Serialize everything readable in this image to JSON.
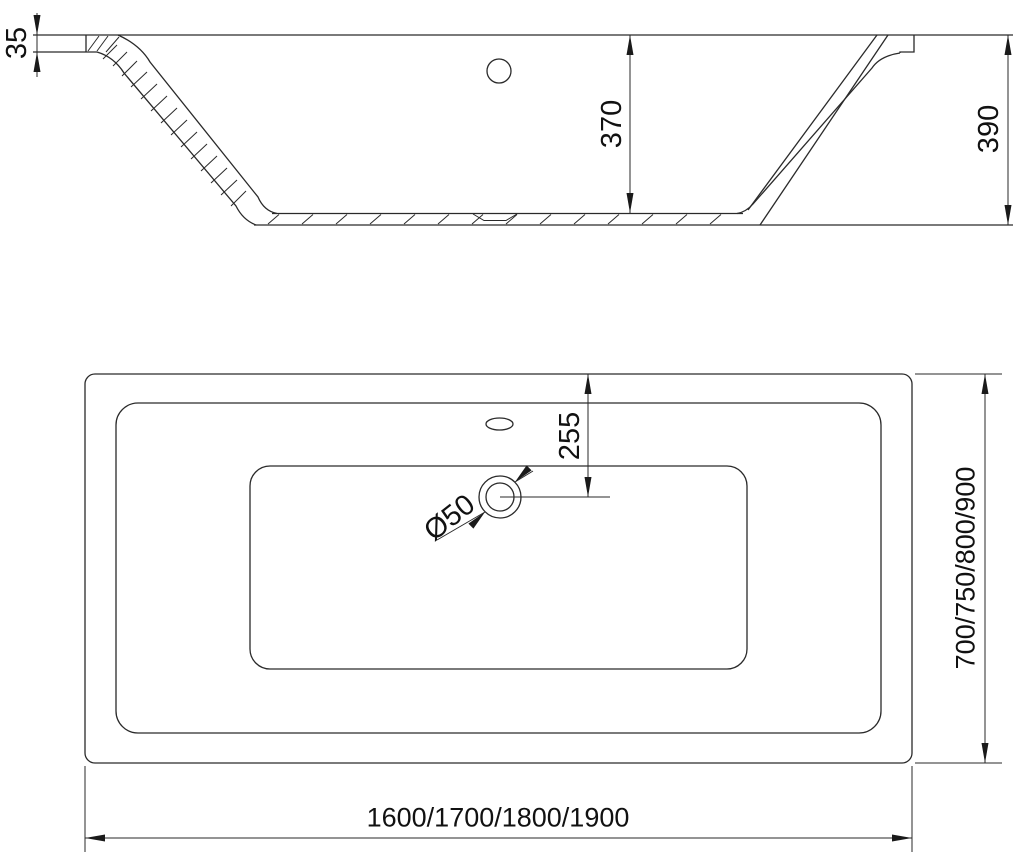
{
  "drawing": {
    "title": "bathtub-technical-drawing",
    "background_color": "#ffffff",
    "line_color": "#2a2a2a",
    "side_view": {
      "description": "longitudinal section of bathtub",
      "dimensions": {
        "rim_thickness": "35",
        "inner_depth": "370",
        "overall_height": "390"
      }
    },
    "plan_view": {
      "description": "top plan view of bathtub",
      "dimensions": {
        "drain_offset": "255",
        "drain_diameter": "Ø50",
        "overall_length": "1600/1700/1800/1900",
        "overall_width": "700/750/800/900"
      }
    }
  }
}
